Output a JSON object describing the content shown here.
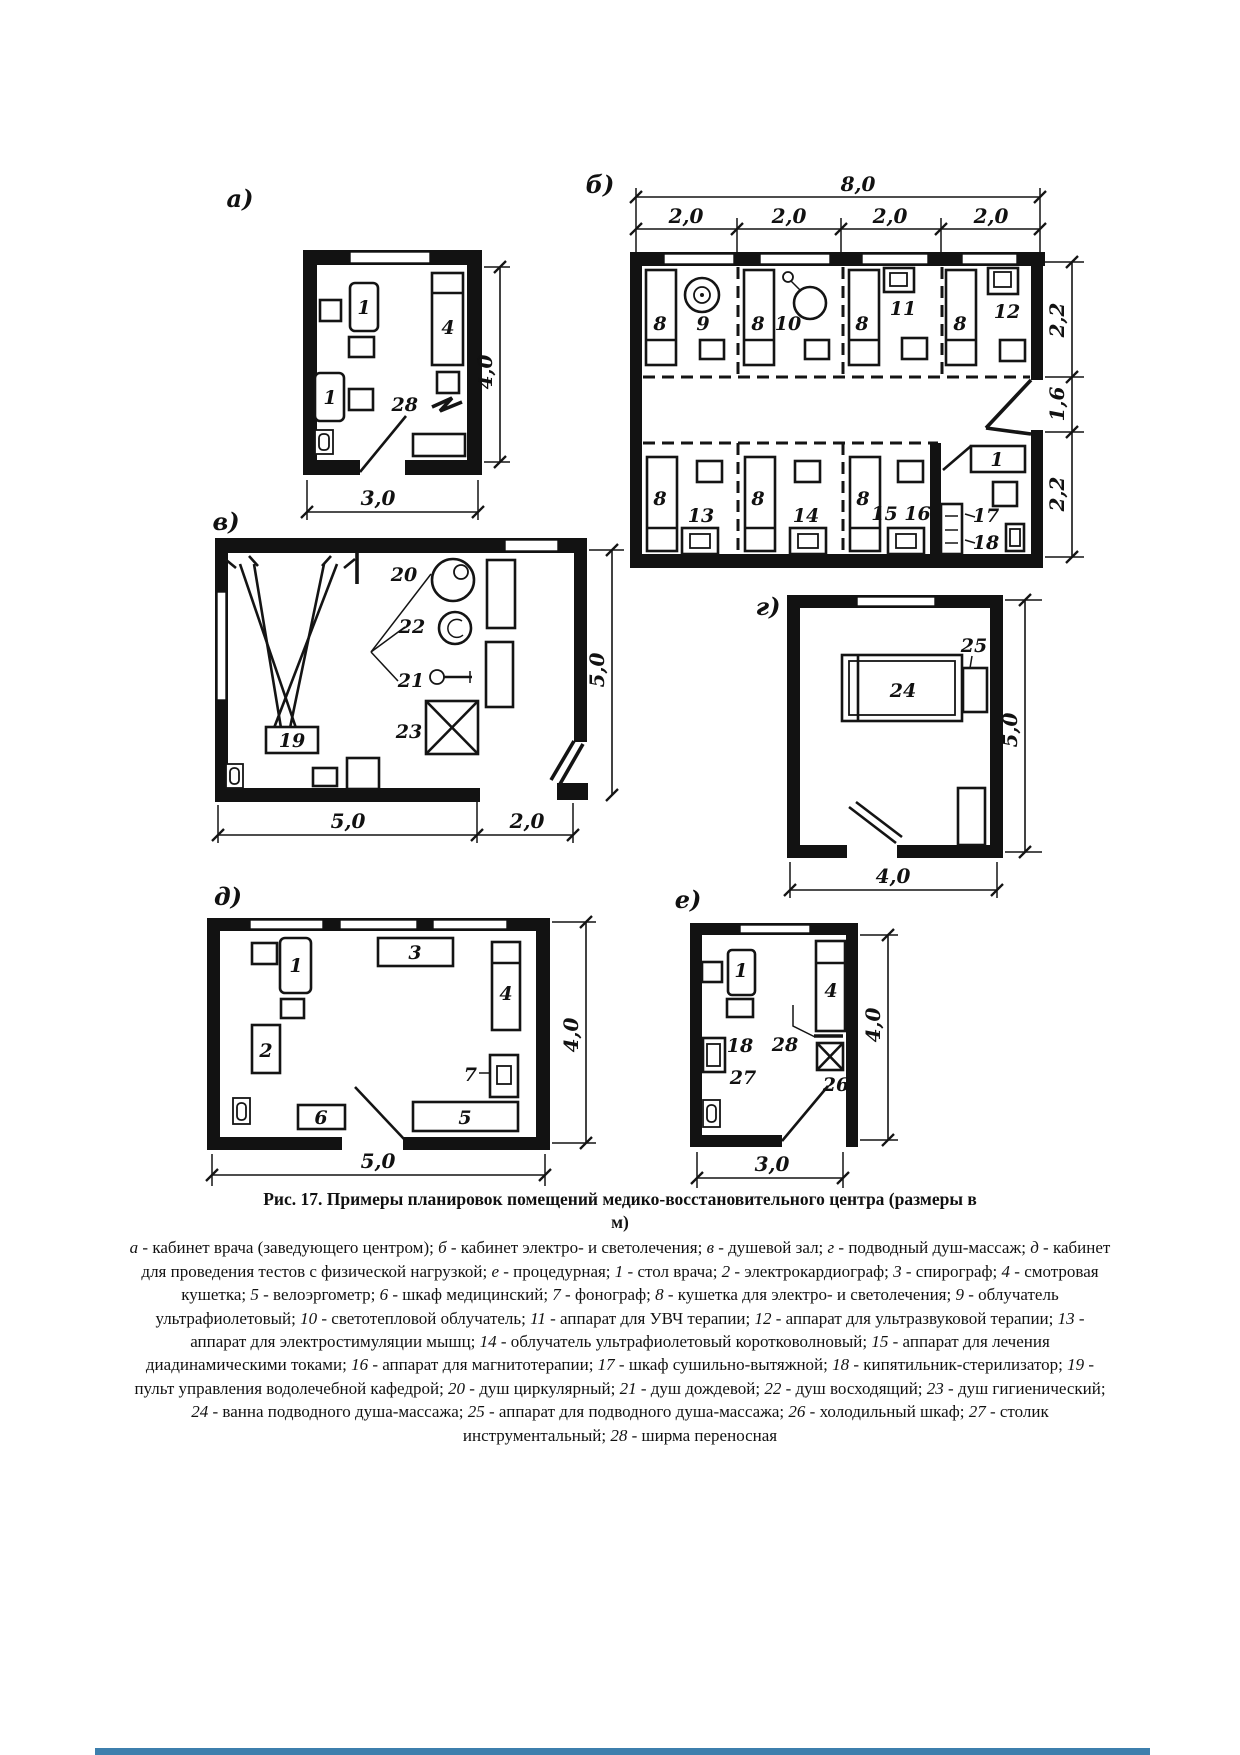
{
  "figure": {
    "title_line1": "Рис. 17. Примеры планировок помещений медико-восстановительного центра (размеры в",
    "title_line2": "м)",
    "legend": [
      {
        "k": "а",
        "v": "кабинет врача (заведующего центром)"
      },
      {
        "k": "б",
        "v": "кабинет электро- и светолечения"
      },
      {
        "k": "в",
        "v": "душевой зал"
      },
      {
        "k": "г",
        "v": "подводный душ-массаж"
      },
      {
        "k": "д",
        "v": "кабинет для проведения тестов с физической нагрузкой"
      },
      {
        "k": "е",
        "v": "процедурная"
      },
      {
        "k": "1",
        "v": "стол врача"
      },
      {
        "k": "2",
        "v": "электрокардиограф"
      },
      {
        "k": "3",
        "v": "спирограф"
      },
      {
        "k": "4",
        "v": "смотровая кушетка"
      },
      {
        "k": "5",
        "v": "велоэргометр"
      },
      {
        "k": "6",
        "v": "шкаф медицинский"
      },
      {
        "k": "7",
        "v": "фонограф"
      },
      {
        "k": "8",
        "v": "кушетка для электро- и светолечения"
      },
      {
        "k": "9",
        "v": "облучатель ультрафиолетовый"
      },
      {
        "k": "10",
        "v": "светотепловой облучатель"
      },
      {
        "k": "11",
        "v": "аппарат для УВЧ терапии"
      },
      {
        "k": "12",
        "v": "аппарат для ультразвуковой терапии"
      },
      {
        "k": "13",
        "v": "аппарат для электростимуляции мышц"
      },
      {
        "k": "14",
        "v": "облучатель ультрафиолетовый коротковолновый"
      },
      {
        "k": "15",
        "v": "аппарат для лечения диадинамическими токами"
      },
      {
        "k": "16",
        "v": "аппарат для магнитотерапии"
      },
      {
        "k": "17",
        "v": "шкаф сушильно-вытяжной"
      },
      {
        "k": "18",
        "v": "кипятильник-стерилизатор"
      },
      {
        "k": "19",
        "v": "пульт управления водолечебной кафедрой"
      },
      {
        "k": "20",
        "v": "душ циркулярный"
      },
      {
        "k": "21",
        "v": "душ дождевой"
      },
      {
        "k": "22",
        "v": "душ восходящий"
      },
      {
        "k": "23",
        "v": "душ гигиенический"
      },
      {
        "k": "24",
        "v": "ванна подводного душа-массажа"
      },
      {
        "k": "25",
        "v": "аппарат для подводного душа-массажа"
      },
      {
        "k": "26",
        "v": "холодильный шкаф"
      },
      {
        "k": "27",
        "v": "столик инструментальный"
      },
      {
        "k": "28",
        "v": "ширма переносная"
      }
    ]
  },
  "plans": {
    "a": {
      "label": "а)",
      "desk": "1",
      "couch": "4",
      "screen": "28",
      "dim_height": "4,0",
      "dim_width": "3,0"
    },
    "b": {
      "label": "б)",
      "dim_total": "8,0",
      "dim_bay": "2,0",
      "dim_right_top": "2,2",
      "dim_right_mid": "1,6",
      "dim_right_bottom": "2,2",
      "couch": "8",
      "uv_irradiator": "9",
      "heat_irradiator": "10",
      "uhf": "11",
      "ultrasound": "12",
      "myostim": "13",
      "uv_short": "14",
      "diadynamic_magnet": "15 16",
      "drying_cabinet": "17",
      "sterilizer": "18",
      "table": "1"
    },
    "v": {
      "label": "в)",
      "console": "19",
      "circular_shower": "20",
      "rain_shower": "21",
      "ascending_shower": "22",
      "hygienic_shower": "23",
      "dim_height": "5,0",
      "dim_width_main": "5,0",
      "dim_width_annex": "2,0"
    },
    "g": {
      "label": "г)",
      "bath": "24",
      "apparatus": "25",
      "dim_height": "5,0",
      "dim_width": "4,0"
    },
    "d": {
      "label": "д)",
      "desk": "1",
      "ecg": "2",
      "spirograph": "3",
      "couch": "4",
      "bike": "5",
      "cabinet": "6",
      "phonograph": "7",
      "dim_height": "4,0",
      "dim_width": "5,0"
    },
    "e": {
      "label": "е)",
      "desk": "1",
      "couch": "4",
      "sterilizer": "18",
      "fridge": "26",
      "instrument_table": "27",
      "screen": "28",
      "dim_height": "4,0",
      "dim_width": "3,0"
    }
  },
  "ui": {
    "bottom_bar_color": "#3d7fad"
  }
}
